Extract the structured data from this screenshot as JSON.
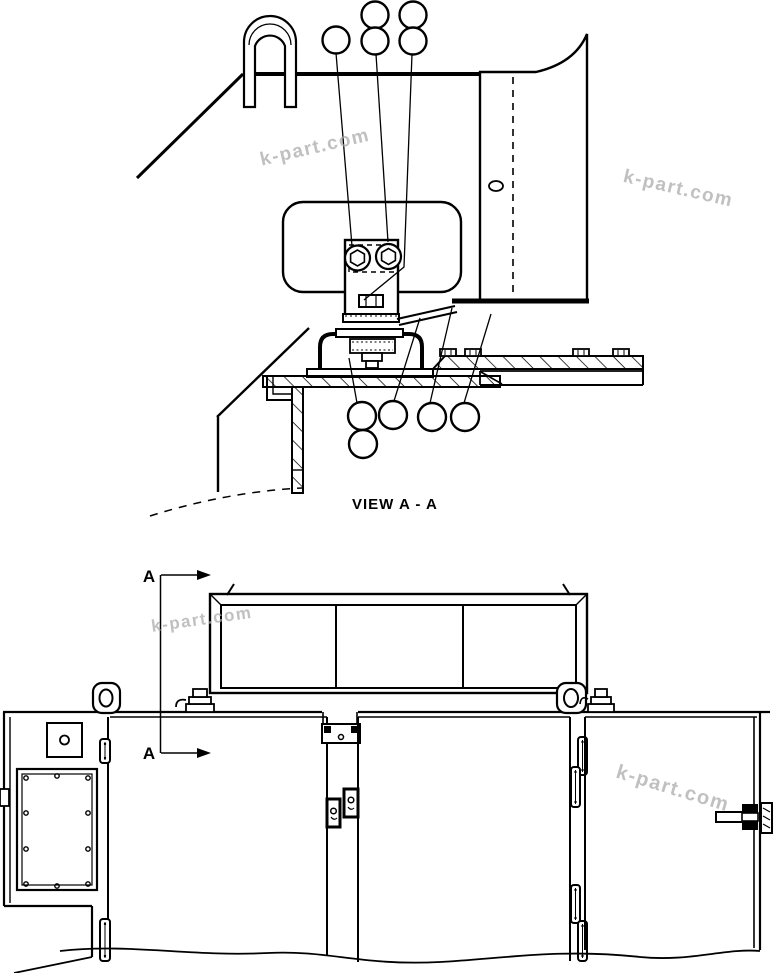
{
  "page": {
    "background_color": "#ffffff",
    "line_color": "#000000",
    "watermark_color": "#a9a9a9"
  },
  "top_view": {
    "caption": "VIEW A - A"
  },
  "front_view": {
    "section_marker": "A"
  },
  "watermark": {
    "text": "k-part.com"
  }
}
